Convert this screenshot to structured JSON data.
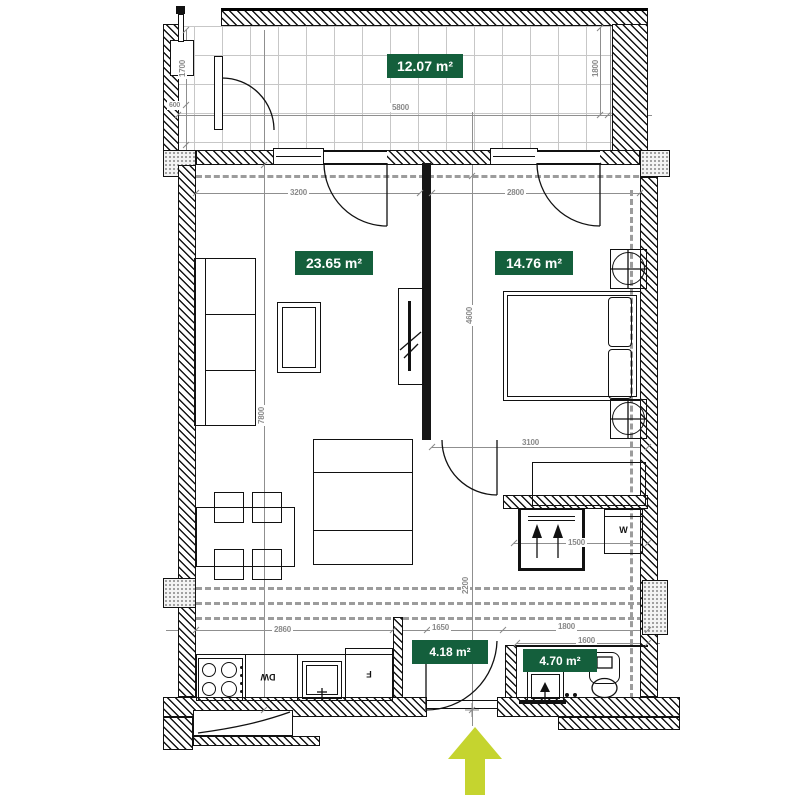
{
  "areas": {
    "balcony": "12.07 m²",
    "living": "23.65 m²",
    "bedroom": "14.76 m²",
    "hallway": "4.18 m²",
    "bathroom": "4.70 m²"
  },
  "dims": {
    "balcony_width": "5800",
    "balcony_depth": "1800",
    "balcony_left_upper": "1700",
    "balcony_left_lower": "600",
    "living_width": "3200",
    "bedroom_width": "2800",
    "apartment_height": "7800",
    "middle_upper": "4600",
    "middle_lower": "2200",
    "bedroom_inner": "3100",
    "closet_width": "1500",
    "kitchen_width": "2860",
    "hallway_width": "1650",
    "bathroom_outer": "1800",
    "bathroom_inner": "1600"
  },
  "appliances": {
    "dishwasher": "DW",
    "fridge": "F",
    "washer": "W"
  },
  "colors": {
    "area_badge_green": "#145f3c",
    "entrance_arrow_yellow": "#c5d42f",
    "wall_black": "#161616",
    "dimension_gray": "#8a8a8a"
  }
}
